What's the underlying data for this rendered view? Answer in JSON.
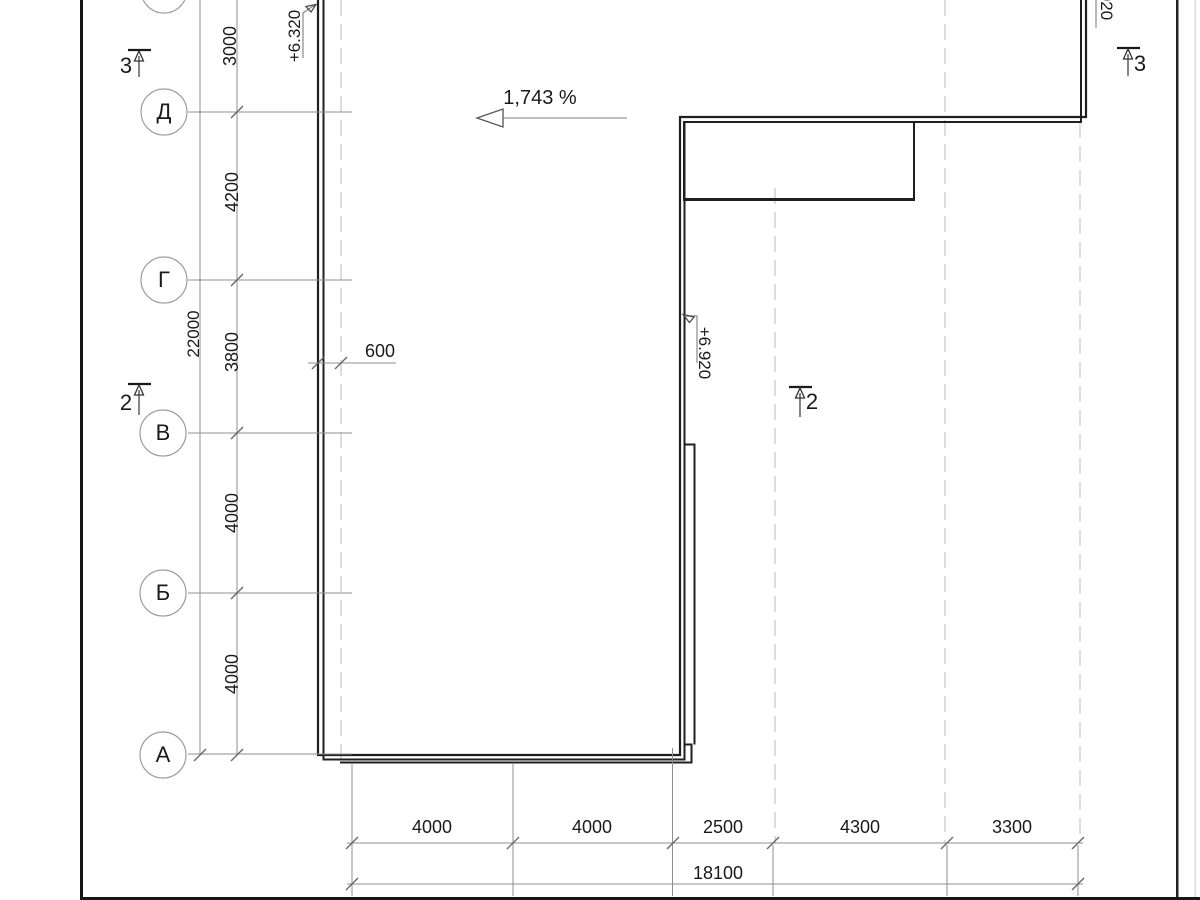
{
  "drawing": {
    "grid_rows": {
      "labels": [
        "Д",
        "Г",
        "В",
        "Б",
        "А"
      ]
    },
    "dims_vertical": {
      "segments": [
        "3000",
        "4200",
        "3800",
        "4000",
        "4000"
      ],
      "total": "22000"
    },
    "dims_horizontal": {
      "segments": [
        "4000",
        "4000",
        "2500",
        "4300",
        "3300"
      ],
      "total": "18100"
    },
    "dims_other": {
      "offset": "600"
    },
    "annotations": {
      "slope": "1,743 %",
      "elevation_top_left": "+6.320",
      "elevation_inner": "+6.920",
      "elevation_top_right": "+6.920",
      "sections": {
        "left_top": "3",
        "left_mid": "2",
        "inner_mid": "2",
        "right_top": "3"
      }
    },
    "colors": {
      "background": "#ffffff",
      "outline_strong": "#1f1f1f",
      "dim_line": "#8f8f8f",
      "dashed_axis": "#c9c9c9",
      "text": "#1a1a1a",
      "frame": "#161616"
    }
  }
}
